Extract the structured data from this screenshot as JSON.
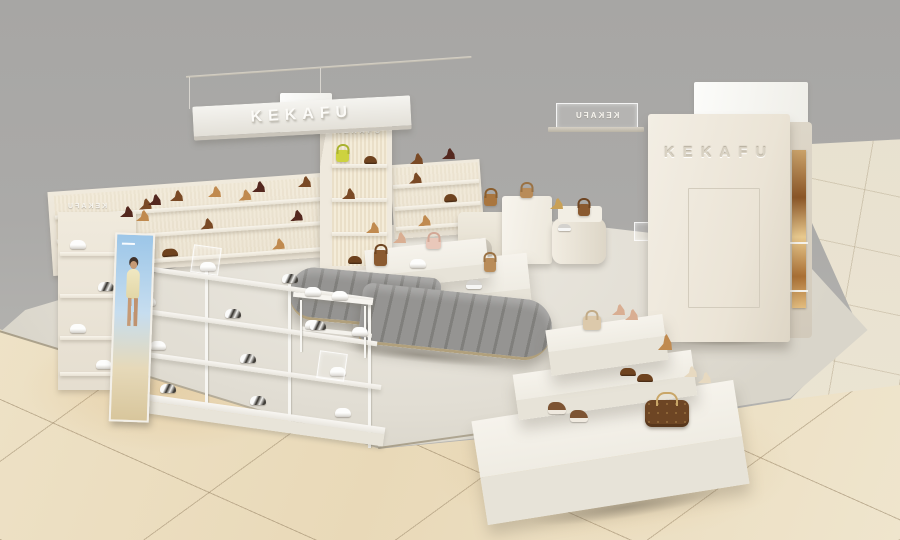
{
  "brand": "KEKAFU",
  "signs": {
    "hanging": "KEKAFU",
    "cabinet": "KEKAFU",
    "left_shelf": "KEKAFU",
    "center_hanging": "KEKAFU",
    "tower": "KEKAFU"
  },
  "colors": {
    "wall_gray": "#a9a8a6",
    "kiosk_floor": "#e1ddd3",
    "marble_floor": "#ebdcbc",
    "shelf_cream": "#ebe5d8",
    "fluted_panel": "#f0e8d4",
    "bench_gray": "#8a8987",
    "bench_base_gold": "#b1a07c",
    "accent_bag_yellow": "#cdd23f",
    "leather_brown": "#6f431f",
    "nude_heel": "#d9ae92"
  },
  "products_visible": [
    "white-sneakers",
    "black-white-sneakers",
    "gray-sneakers",
    "brown-high-top-sneakers",
    "nude-heels",
    "cream-heels",
    "brown-heels",
    "dark-heels",
    "tan-wedge-sandal",
    "brown-loafers",
    "yellow-handbag",
    "pink-handbag",
    "brown-handbag",
    "tan-handbag",
    "beige-crossbody-bag",
    "monogram-duffel-bag"
  ]
}
